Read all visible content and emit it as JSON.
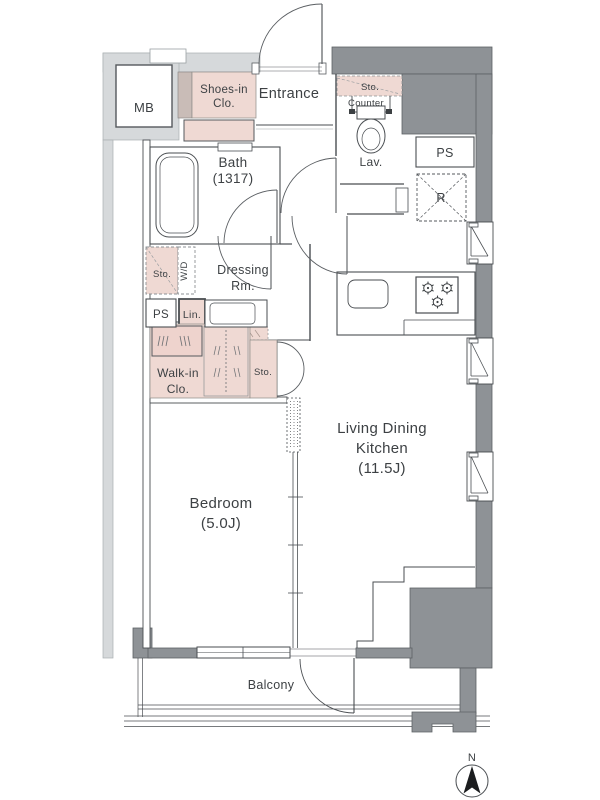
{
  "meta": {
    "type": "apartment-floor-plan",
    "canvas": "600x800"
  },
  "colors": {
    "wall_dark": "#8e9296",
    "wall_light": "#d6d9db",
    "closet_pink": "#efd9d3",
    "shoes_dark_strip": "#c9bcb7",
    "line": "#4a4e52",
    "text": "#3d4144",
    "compass_needle": "#1b1d1f"
  },
  "labels": {
    "mb": "MB",
    "shoes_1": "Shoes-in",
    "shoes_2": "Clo.",
    "entrance": "Entrance",
    "lav_sto": "Sto.",
    "lav_counter": "Counter",
    "lav": "Lav.",
    "ps_right": "PS",
    "fridge": "R",
    "bath_1": "Bath",
    "bath_2": "(1317)",
    "dress_sto": "Sto.",
    "washer": "W/D",
    "dress_1": "Dressing",
    "dress_2": "Rm.",
    "ps_left": "PS",
    "linen": "Lin.",
    "walkin_1": "Walk-in",
    "walkin_2": "Clo.",
    "sto_mid": "Sto.",
    "ldk_1": "Living Dining",
    "ldk_2": "Kitchen",
    "ldk_3": "(11.5J)",
    "bedroom_1": "Bedroom",
    "bedroom_2": "(5.0J)",
    "balcony": "Balcony",
    "north": "N"
  }
}
